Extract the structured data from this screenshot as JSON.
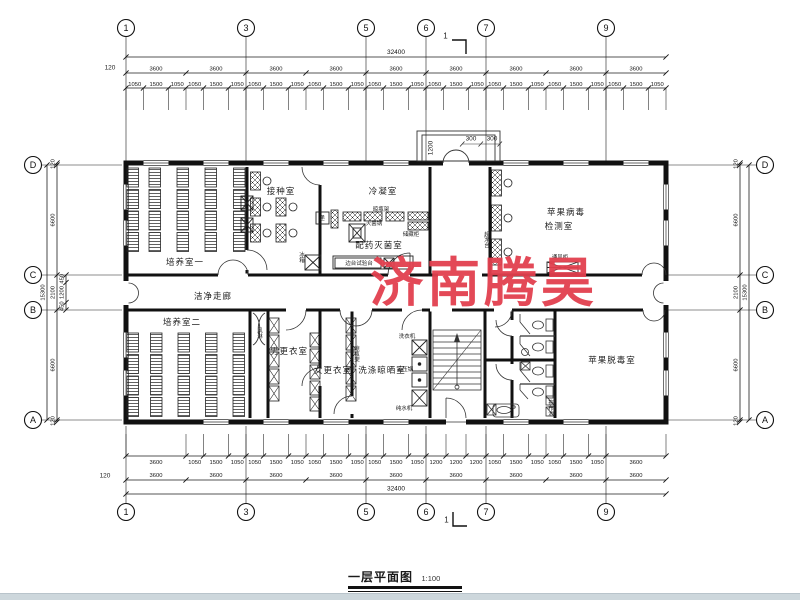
{
  "watermark": {
    "text": "济南腾昊",
    "color": "#e2404f"
  },
  "title": {
    "text": "一层平面图",
    "scale": "1:100"
  },
  "section_marker": "1",
  "grid": {
    "horizontal": [
      {
        "label": "1",
        "mm": 0
      },
      {
        "label": "3",
        "mm": 7200
      },
      {
        "label": "5",
        "mm": 14400
      },
      {
        "label": "6",
        "mm": 18000
      },
      {
        "label": "7",
        "mm": 21600
      },
      {
        "label": "9",
        "mm": 28800
      }
    ],
    "vertical": [
      {
        "label": "D",
        "mm": 0
      },
      {
        "label": "C",
        "mm": 6600
      },
      {
        "label": "B",
        "mm": 8700
      },
      {
        "label": "A",
        "mm": 15300
      }
    ]
  },
  "dimensions": {
    "total_width": "32400",
    "total_height": "15300",
    "offset": "120",
    "top": {
      "fine": [
        "1050",
        "1500",
        "1050",
        "1050",
        "1500",
        "1050",
        "1050",
        "1500",
        "1050",
        "1050",
        "1500",
        "1050",
        "1050",
        "1500",
        "1050",
        "1050",
        "1500",
        "1050",
        "1050",
        "1500",
        "1050",
        "1050",
        "1500",
        "1050",
        "1050",
        "1500",
        "1050"
      ],
      "coarse": [
        "3600",
        "3600",
        "3600",
        "3600",
        "3600",
        "3600",
        "3600",
        "3600",
        "3600"
      ]
    },
    "bottom": {
      "fine": [
        "3600",
        "1050",
        "1500",
        "1050",
        "1050",
        "1500",
        "1050",
        "1050",
        "1500",
        "1050",
        "1050",
        "1500",
        "1050",
        "1200",
        "1200",
        "1200",
        "1050",
        "1500",
        "1050",
        "1050",
        "1500",
        "1050",
        "3600"
      ],
      "coarse": [
        "3600",
        "3600",
        "3600",
        "3600",
        "3600",
        "3600",
        "3600",
        "3600",
        "3600"
      ]
    },
    "side": {
      "segments": [
        "120",
        "6600",
        "2100",
        "6600",
        "120"
      ],
      "corridor_sub": [
        "450",
        "1200",
        "450"
      ]
    },
    "porch": {
      "depth": "1200",
      "step_left": "300",
      "step_right": "300"
    }
  },
  "rooms": {
    "culture1": "培养室一",
    "inoculation": "接种室",
    "condensation": "冷凝室",
    "prep_steril": "配药灭菌室",
    "virus_line1": "苹果病毒",
    "virus_line2": "检测室",
    "corridor": "洁净走廊",
    "culture2": "培养室二",
    "men_change": "男更衣室",
    "women_change": "女更衣室",
    "washing": "洗涤晾晒室",
    "detox": "苹果脱毒室"
  },
  "equipment": {
    "bottle_rack_top": "晾瓶架",
    "sterilizer": "灭菌锅",
    "cabinet": "储藏柜",
    "side_bench": "边台试验台",
    "fridge": "冰箱",
    "pass_window": "递",
    "clean_bench": "超净台",
    "fume_hood": "通风柜",
    "air_shower": "风淋",
    "bottle_rack_bottom": "晾瓶架",
    "washer": "洗衣机",
    "autoclave": "高压锅",
    "water_purifier": "纯水机",
    "mop_sink": "拖布池"
  }
}
